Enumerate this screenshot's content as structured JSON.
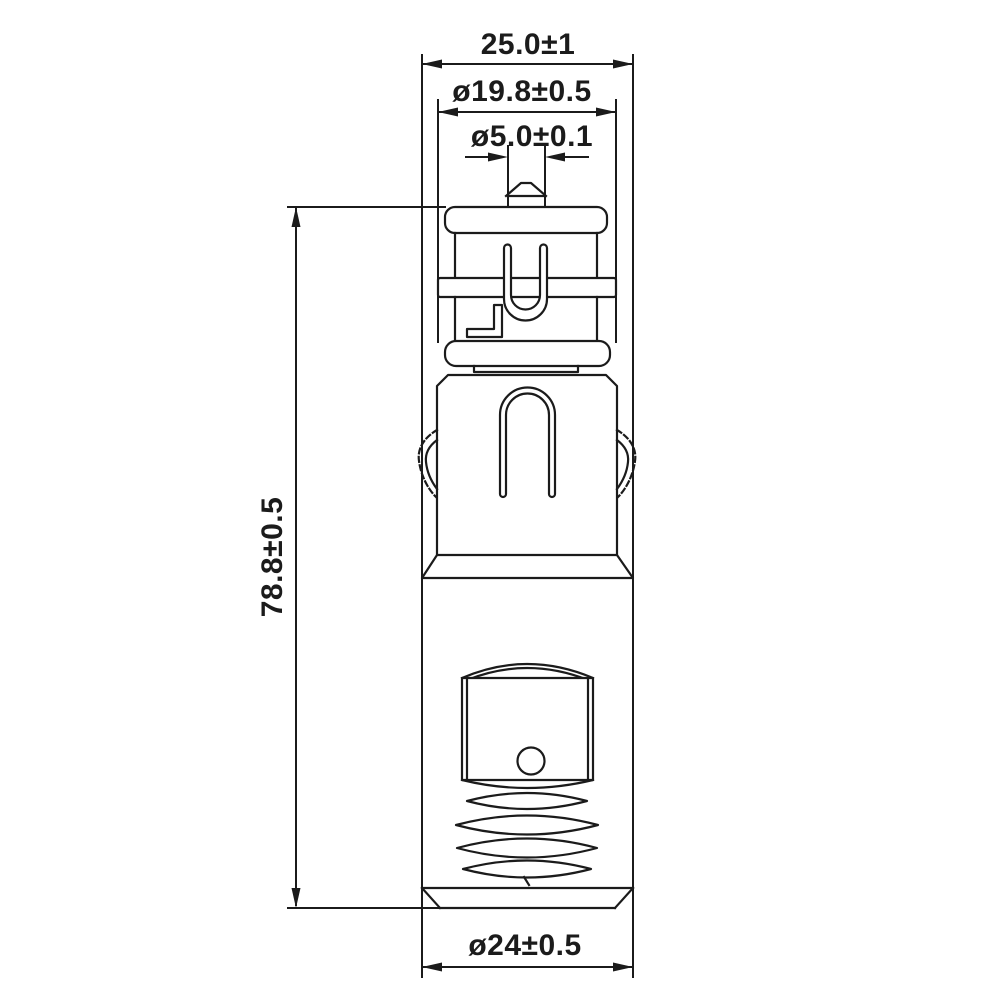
{
  "drawing": {
    "background": "#ffffff",
    "line_color": "#1b1b1b",
    "diameter_symbol": "ø",
    "dimensions": {
      "overall_width": {
        "label": "25.0±1",
        "value": 25.0,
        "tolerance": 1.0
      },
      "contact_band_diameter": {
        "label": "ø19.8±0.5",
        "value": 19.8,
        "tolerance": 0.5
      },
      "tip_diameter": {
        "label": "ø5.0±0.1",
        "value": 5.0,
        "tolerance": 0.1
      },
      "overall_length": {
        "label": "78.8±0.5",
        "value": 78.8,
        "tolerance": 0.5
      },
      "body_diameter": {
        "label": "ø24±0.5",
        "value": 24.0,
        "tolerance": 0.5
      }
    }
  }
}
